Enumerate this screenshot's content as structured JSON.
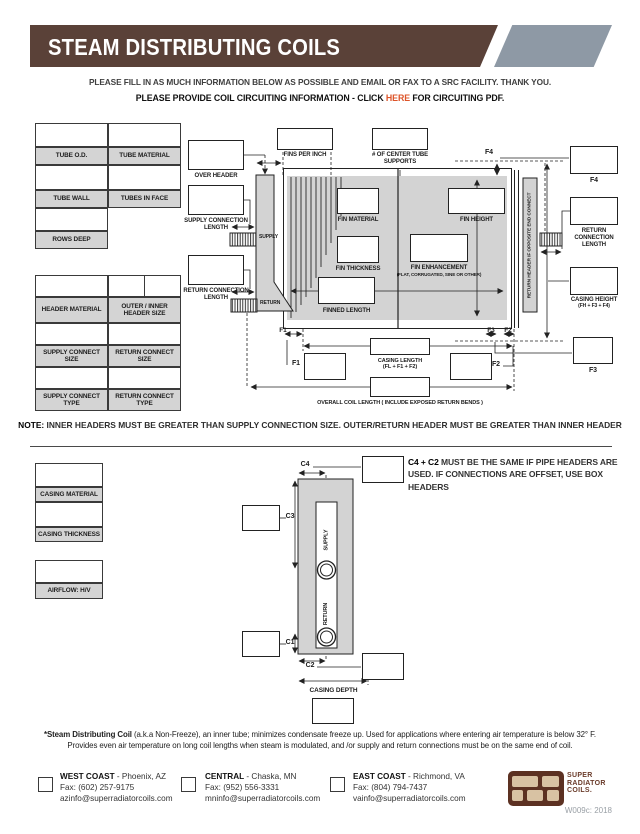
{
  "banner": {
    "title": "STEAM DISTRIBUTING COILS"
  },
  "instructions": {
    "line1": "PLEASE FILL IN AS MUCH INFORMATION BELOW AS POSSIBLE AND EMAIL OR FAX TO A SRC FACILITY.  THANK YOU.",
    "line2_prefix": "PLEASE PROVIDE COIL CIRCUITING INFORMATION - CLICK ",
    "line2_link": "HERE",
    "line2_suffix": " FOR CIRCUITING PDF."
  },
  "tube_table": {
    "labels": [
      "TUBE O.D.",
      "TUBE MATERIAL",
      "TUBE WALL",
      "TUBES IN FACE",
      "ROWS DEEP"
    ]
  },
  "header_table": {
    "labels": [
      "HEADER MATERIAL",
      "OUTER / INNER HEADER SIZE",
      "SUPPLY CONNECT SIZE",
      "RETURN CONNECT SIZE",
      "SUPPLY CONNECT TYPE",
      "RETURN CONNECT TYPE"
    ]
  },
  "note": {
    "label": "NOTE:",
    "text": " INNER HEADERS MUST BE GREATER THAN SUPPLY CONNECTION SIZE. OUTER/RETURN HEADER MUST BE GREATER THAN INNER HEADER"
  },
  "coil_diagram": {
    "over_header": "OVER HEADER",
    "fins_per_inch": "FINS PER INCH",
    "center_tube_supports": "# OF CENTER TUBE SUPPORTS",
    "supply_connection_length": "SUPPLY CONNECTION LENGTH",
    "return_connection_length": "RETURN CONNECTION LENGTH",
    "supply_pipe": "SUPPLY",
    "return_pipe": "RETURN",
    "fin_material": "FIN MATERIAL",
    "fin_height": "FIN HEIGHT",
    "fin_thickness": "FIN THICKNESS",
    "fin_enhancement": "FIN ENHANCEMENT",
    "fin_enhancement_sub": "(FLAT, CORRUGATED, SINE OR OTHER)",
    "finned_length": "FINNED LENGTH",
    "return_header_note": "RETURN HEADER IF OPPOSITE END CONNECT",
    "f4_marker": "F4",
    "f4_label": "F4",
    "return_connection_length_right": "RETURN CONNECTION LENGTH",
    "casing_height": "CASING HEIGHT",
    "casing_height_sub": "(FH + F3 + F4)",
    "f3_label": "F3",
    "f1_marker": "F1",
    "f3_marker": "F3",
    "f2_marker": "F2",
    "f1_label": "F1",
    "f2_label": "F2",
    "casing_length": "CASING LENGTH",
    "casing_length_sub": "(FL + F1 + F2)",
    "overall_length": "OVERALL COIL LENGTH  ( INCLUDE EXPOSED RETURN BENDS )"
  },
  "casing_table": {
    "labels": [
      "CASING MATERIAL",
      "CASING THICKNESS"
    ]
  },
  "airflow_table": {
    "labels": [
      "AIRFLOW: H/V"
    ]
  },
  "depth_diagram": {
    "c4": "C4",
    "c3": "C3",
    "c1": "C1",
    "c2": "C2",
    "supply": "SUPPLY",
    "return": "RETURN",
    "casing_depth": "CASING DEPTH",
    "note_bold": "C4 + C2",
    "note_text": " MUST BE THE SAME IF PIPE HEADERS ARE USED. IF CONNECTIONS ARE OFFSET, USE BOX HEADERS"
  },
  "footnote": {
    "bold": "*Steam Distributing Coil",
    "text1": " (a.k.a Non-Freeze), an inner tube; minimizes condensate freeze up. Used for applications where entering air temperature is below 32° F.",
    "text2": "Provides even air temperature on long coil lengths when steam is modulated, and /or supply and return connections must be on the same end of coil."
  },
  "footer": {
    "locations": [
      {
        "name": "WEST COAST",
        "city": " - Phoenix, AZ",
        "fax": "Fax: (602) 257-9175",
        "email": "azinfo@superradiatorcoils.com"
      },
      {
        "name": "CENTRAL",
        "city": " - Chaska, MN",
        "fax": "Fax: (952) 556-3331",
        "email": "mninfo@superradiatorcoils.com"
      },
      {
        "name": "EAST COAST",
        "city": " - Richmond, VA",
        "fax": "Fax: (804) 794-7437",
        "email": "vainfo@superradiatorcoils.com"
      }
    ],
    "logo_text": [
      "SUPER",
      "RADIATOR",
      "COILS."
    ],
    "doc_code": "W009c: 2018"
  },
  "colors": {
    "brand_brown": "#5a4138",
    "banner_gray": "#8e99a5",
    "link_orange": "#dd5429",
    "cell_gray": "#d4d4d4",
    "diagram_gray": "#d3d3d3",
    "logo_brown": "#5c3122",
    "logo_tan": "#d8c2a3"
  }
}
